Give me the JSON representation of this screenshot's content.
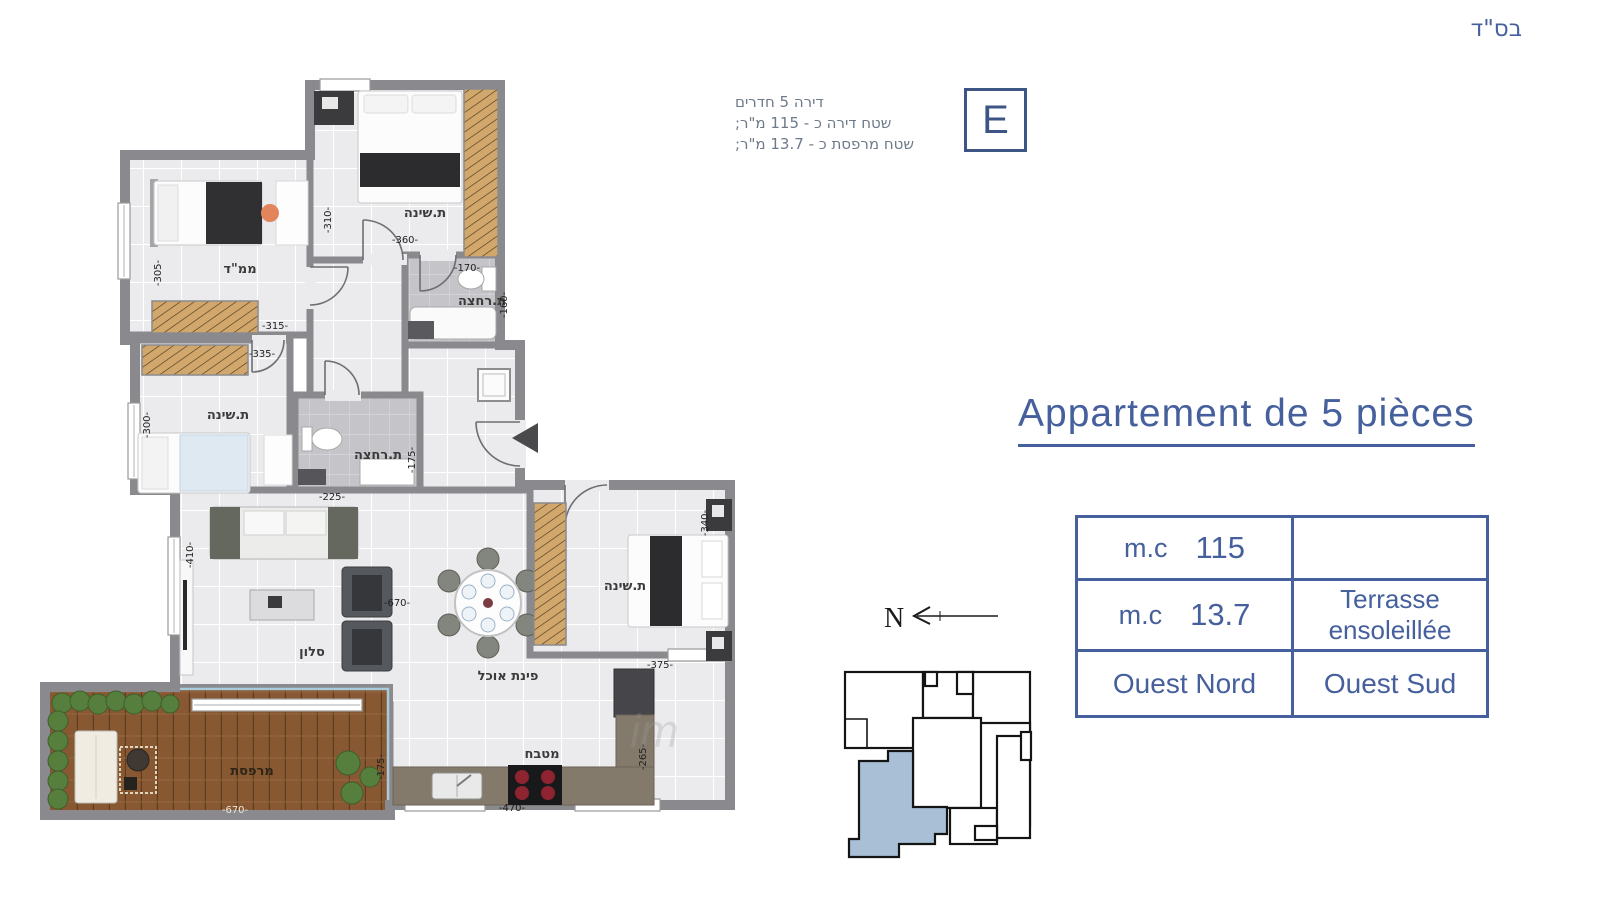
{
  "page": {
    "bsd": "בס\"ד"
  },
  "badge": {
    "letter": "E",
    "info_lines": [
      "דירה 5 חדרים",
      "שטח דירה כ - 115 מ\"ר;",
      "שטח מרפסת כ - 13.7 מ\"ר;"
    ]
  },
  "title": {
    "text": "Appartement de 5 pièces"
  },
  "spec_table": {
    "row1": {
      "unit": "m.c",
      "value": "115",
      "right": ""
    },
    "row2": {
      "unit": "m.c",
      "value": "13.7",
      "right_line1": "Terrasse",
      "right_line2": "ensoleillée"
    },
    "row3": {
      "left": "Ouest Nord",
      "right": "Ouest Sud"
    }
  },
  "compass": {
    "label": "N"
  },
  "floorplan": {
    "labels": {
      "bedroom_top": "ת.שינה",
      "mamad": "ממ\"ד",
      "bedroom_left": "ת.שינה",
      "bath_top": "ת.רחצה",
      "bath_mid": "ת.רחצה",
      "living": "סלון",
      "dining": "פינת אוכל",
      "master": "ת.שינה",
      "kitchen": "מטבח",
      "terrace": "מרפסת"
    },
    "dims": {
      "bedroom_top_v": "-310-",
      "bedroom_top_h": "-360-",
      "mamad_v": "-305-",
      "mamad_h": "-315-",
      "bedroom_left_h": "-335-",
      "bedroom_left_v": "-300-",
      "bath_top_h": "-170-",
      "bath_top_v": "-160-",
      "bath_mid_h": "-225-",
      "bath_mid_v": "-175-",
      "living_v": "-410-",
      "living_h": "-670-",
      "master_v": "-340-",
      "master_h": "-375-",
      "kitchen_h": "-470-",
      "kitchen_v": "-265-",
      "terrace_h": "-670-",
      "terrace_v": "-175-"
    },
    "watermark": "im"
  },
  "colors": {
    "accent": "#45609c",
    "wall": "#8a8a8e",
    "unit_highlight": "#a9bfd6"
  }
}
